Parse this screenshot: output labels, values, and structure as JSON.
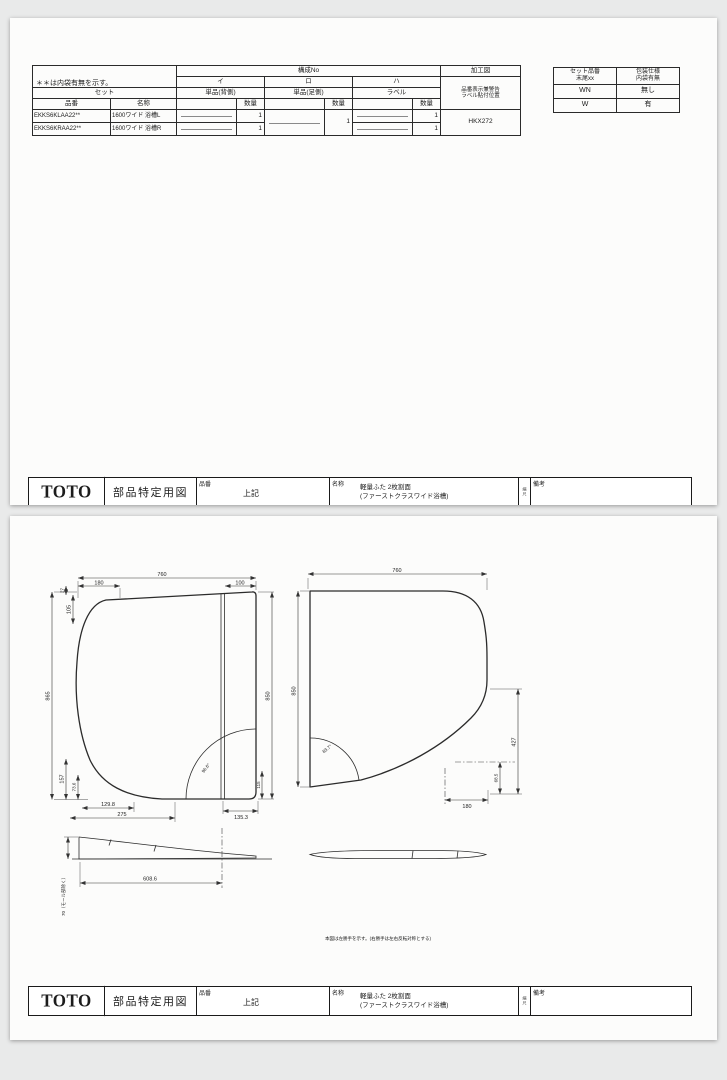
{
  "page1": {
    "spec_table": {
      "note": "＊＊は内袋有無を示す。",
      "kosei_no_label": "構成No",
      "kako_zu_label": "加工図",
      "set_label": "セット",
      "hinban_label": "品番",
      "meisho_label": "名称",
      "qty_label": "数量",
      "groups": [
        {
          "key": "イ",
          "sub": "単品(背側)"
        },
        {
          "key": "ロ",
          "sub": "単品(足側)"
        },
        {
          "key": "ハ",
          "sub": "ラベル"
        }
      ],
      "kako_note_line1": "品番表示兼警告",
      "kako_note_line2": "ラベル貼付位置",
      "kako_value": "HKX272",
      "qty_ro": "1",
      "rows": [
        {
          "hinban": "EKKS6KLAA22**",
          "meisho": "1600ワイド 浴槽L",
          "qty_i": "1",
          "qty_ha": "1"
        },
        {
          "hinban": "EKKS6KRAA22**",
          "meisho": "1600ワイド 浴槽R",
          "qty_i": "1",
          "qty_ha": "1"
        }
      ]
    },
    "bag_table": {
      "col1_line1": "セット品番",
      "col1_line2": "末尾xx",
      "col2_line1": "包装仕様",
      "col2_line2": "内袋有無",
      "rows": [
        {
          "c1": "WN",
          "c2": "無し"
        },
        {
          "c1": "W",
          "c2": "有"
        }
      ]
    }
  },
  "footer": {
    "logo": "TOTO",
    "doc_type": "部品特定用図",
    "hinban_label": "品番",
    "hinban_value": "上記",
    "meisho_label": "名称",
    "meisho_line1": "軽量ふた 2枚割面",
    "meisho_line2": "(ファーストクラスワイド浴槽)",
    "scale_text": "縮尺",
    "biko_label": "備考"
  },
  "page2": {
    "note": "本図は左勝手を示す。(右勝手は左右反転対称とする)",
    "lid_left": {
      "w760": "760",
      "d180": "180",
      "d100": "100",
      "d27": "27",
      "d105": "105",
      "h865": "865",
      "d157": "157",
      "d73_6": "73.6",
      "d129_8": "129.8",
      "d275": "275",
      "d135_3": "135.3",
      "d115": "115",
      "h850": "850",
      "angle": "96.6°"
    },
    "lid_right": {
      "w760": "760",
      "h850": "850",
      "d427": "427",
      "d68_5": "68.5",
      "d180": "180",
      "angle": "83.7°"
    },
    "profile": {
      "d608_6": "608.6",
      "d70": "70（モール部除く）"
    }
  }
}
